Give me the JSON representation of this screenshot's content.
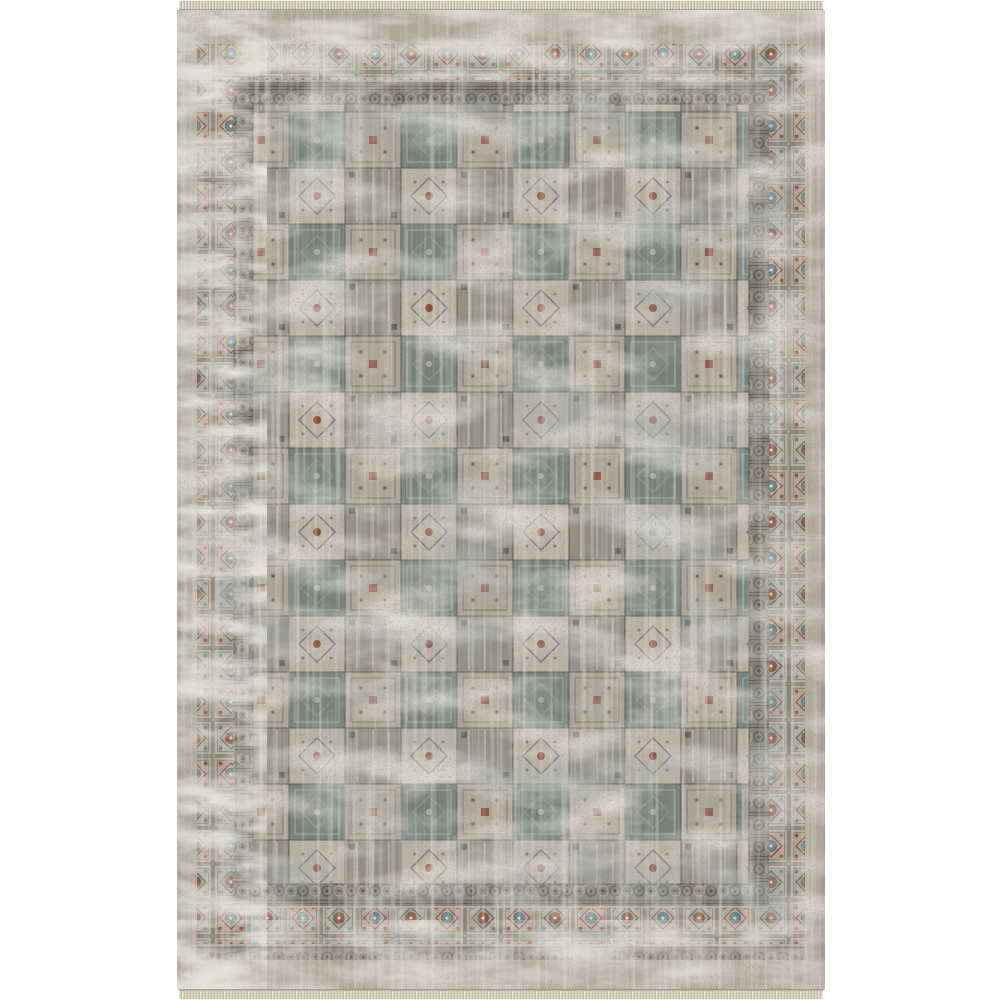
{
  "page": {
    "background_color": "#ffffff",
    "content_type": "product photograph"
  },
  "photo": {
    "alt": "Distressed vintage patchwork area rug in taupe, gray, slate blue and rust with ornamental square-medallion borders and short fringe at the top and bottom edges",
    "subject": "area rug",
    "style": "vintage patchwork, heavily distressed / eroded pile",
    "orientation": "portrait rectangle, centered on white background",
    "features": {
      "fringe": "thin knotted tan fringe along top and bottom edges",
      "outer_band": "plain taupe selvedge band with dark flecks",
      "border_row": "row of boxed square medallions with floral diamond motifs and rust / teal centers",
      "guard_band": "dark mottled scrollwork guard stripe inside the medallion border",
      "field": "grid patchwork of small ornamental tiles, heavily worn, with slate-blue masses, rust patches and vertical streaking"
    },
    "palette": {
      "background_white": "#ffffff",
      "rug_base_taupe": "#b0a89b",
      "field_light_worn": "#c6bfb0",
      "slate_blue": "#65716d",
      "charcoal_flecks": "#4d4a43",
      "rust_red": "#84452f",
      "teal_accent": "#5f828a",
      "guard_dark": "#827d72",
      "fringe_tan": "#d6cdb9"
    }
  }
}
